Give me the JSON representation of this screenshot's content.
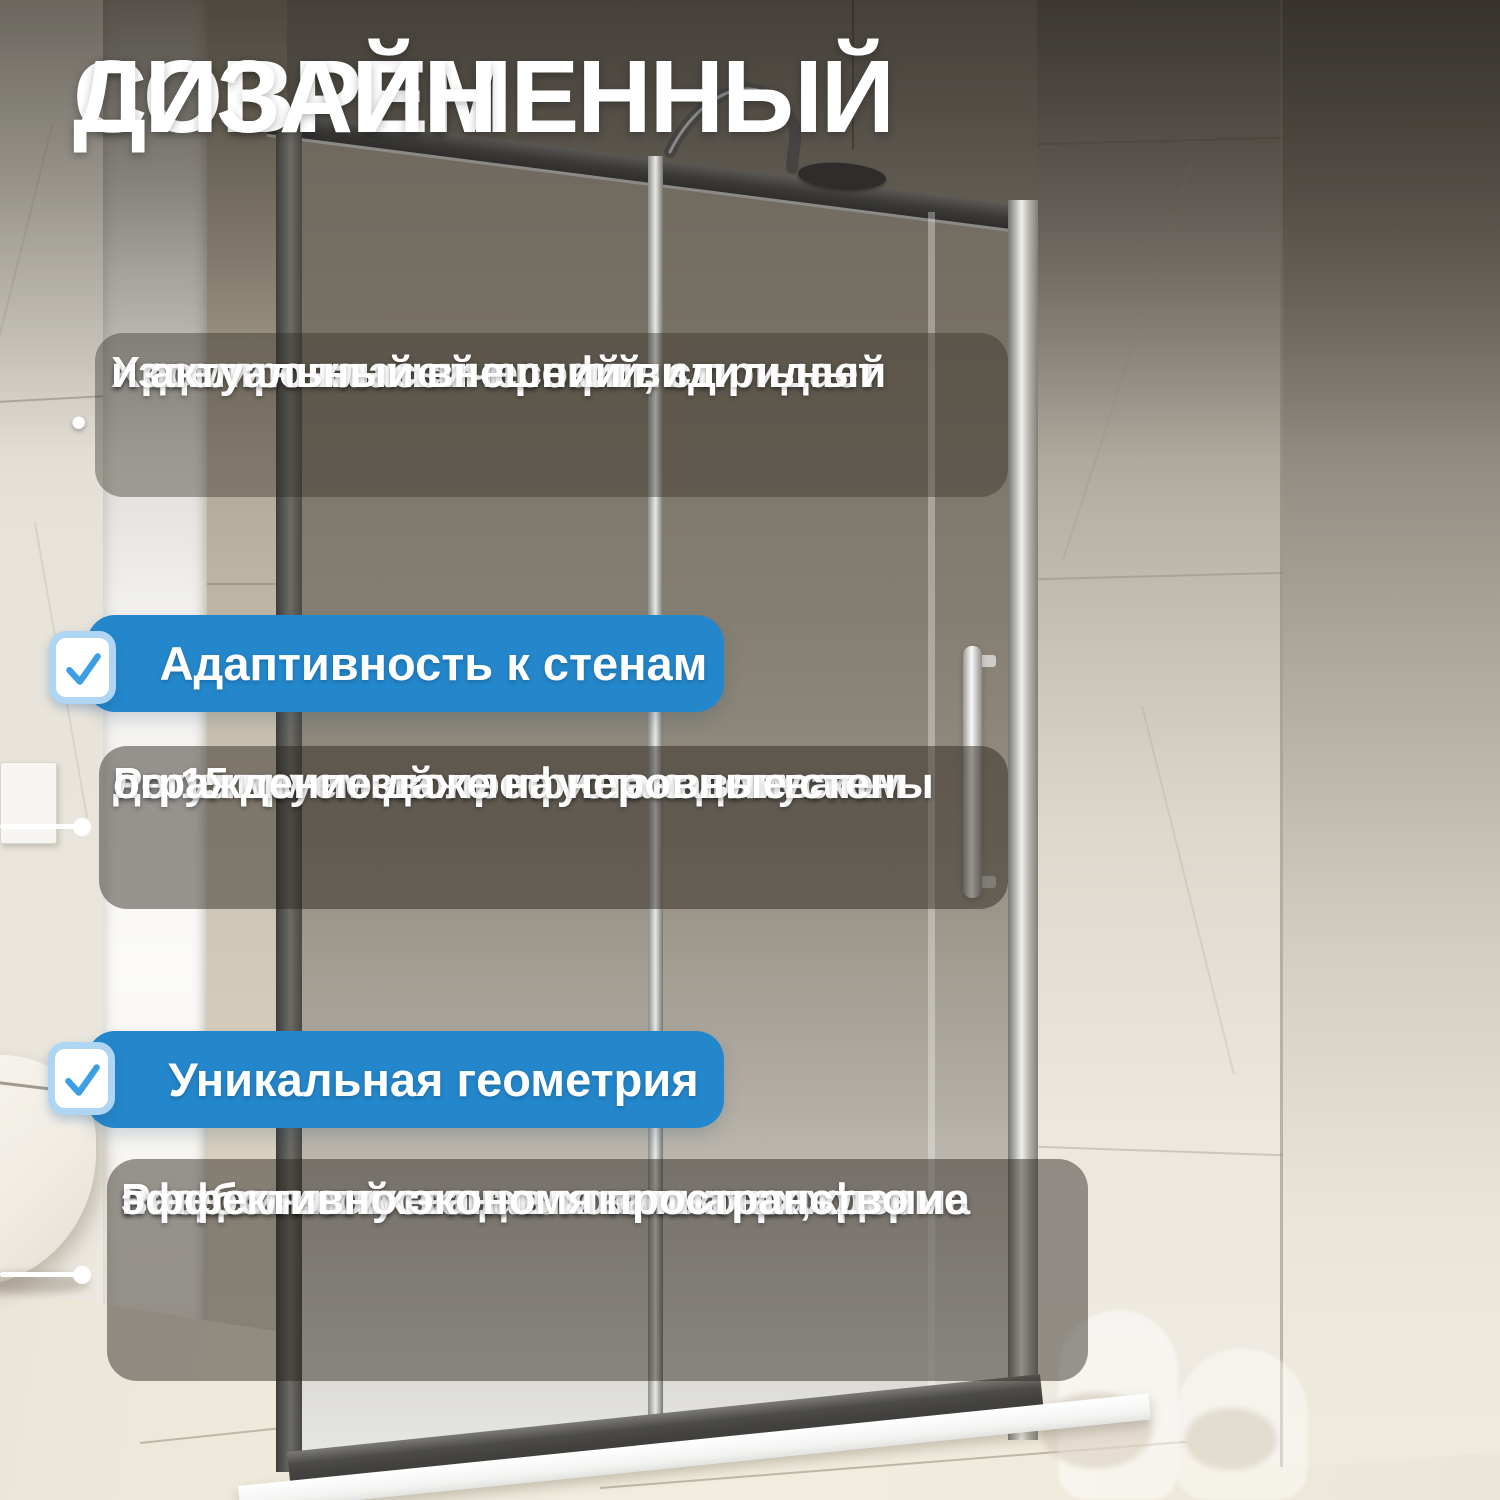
{
  "title": {
    "lines": [
      "СОВРЕМЕННЫЙ",
      "ДИЗАЙН"
    ]
  },
  "intro": {
    "bullet": "•",
    "lines": [
      "Хромированный профиль придает",
      "изделию классичесский, стильный",
      "и актуальный внешний вид"
    ]
  },
  "features": [
    {
      "heading": "Адаптивность к стенам",
      "icon": "check-icon",
      "lines": [
        "Регулируемый профиль с допуском",
        "до 15 мм позволяет устанавливать",
        "ограждение даже на неровные стены"
      ]
    },
    {
      "heading": "Уникальная геометрия",
      "icon": "check-icon",
      "lines": [
        "Раздвижной вход и компактная форма",
        "позволяют устанавливать ограждение",
        "в небольших ванных комнатах,",
        "эффективно экономя пространство"
      ]
    }
  ],
  "colors": {
    "accent_blue": "#2487cb",
    "check_blue": "#3d9ee3",
    "checkbox_border": "#aed6f2",
    "text_white": "#ffffff"
  }
}
